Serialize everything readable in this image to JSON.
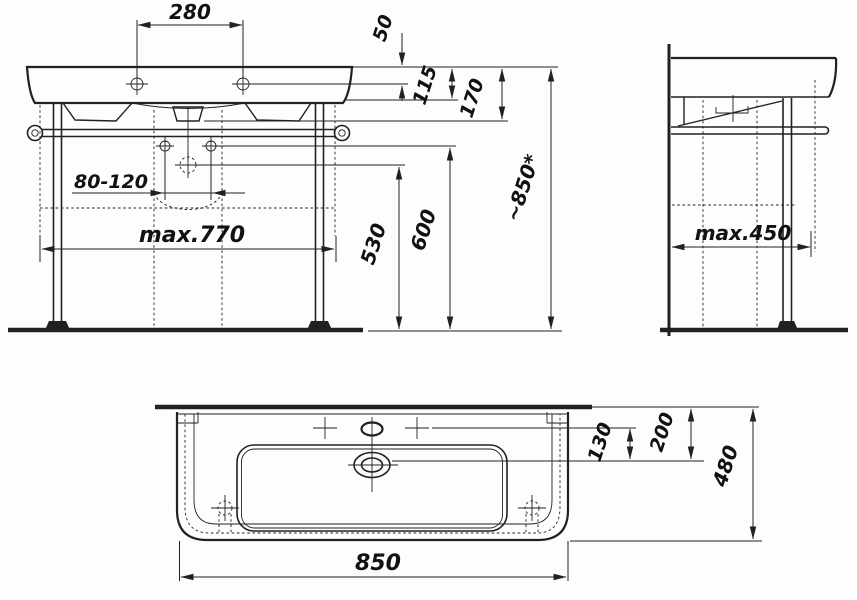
{
  "style": {
    "line_color": "#212121",
    "text_color": "#111111",
    "background": "#fdfdfd"
  },
  "front_view": {
    "dims": {
      "hole_spacing": "280",
      "rim_to_tap_deck": "50",
      "deck_thickness": "115",
      "deck_to_drain": "170",
      "wall_bolt_spacing": "80-120",
      "frame_width": "max.770",
      "height_530": "530",
      "height_600": "600",
      "rim_height": "~850*"
    }
  },
  "side_view": {
    "dims": {
      "frame_depth": "max.450"
    }
  },
  "plan_view": {
    "dims": {
      "rear_to_tap": "130",
      "rear_to_drain": "200",
      "total_depth": "480",
      "total_width": "850"
    }
  }
}
